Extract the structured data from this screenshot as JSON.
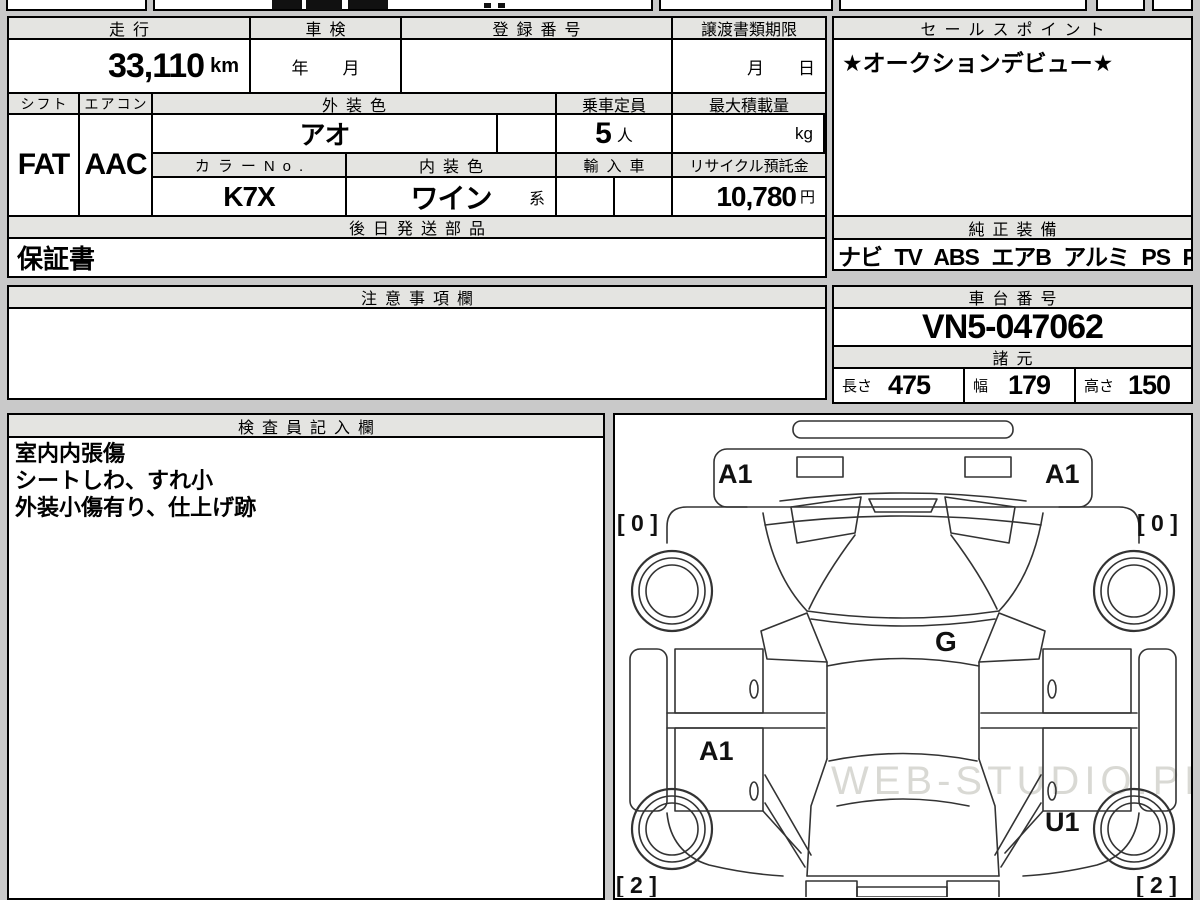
{
  "main_table": {
    "mileage": {
      "header": "走行",
      "value": "33,110",
      "unit": "km"
    },
    "shaken": {
      "header": "車検",
      "placeholder": "年　　月"
    },
    "registration": {
      "header": "登録番号",
      "value": ""
    },
    "transfer_deadline": {
      "header": "譲渡書類期限",
      "placeholder": "月　　日"
    },
    "shift": {
      "header": "シフト",
      "value": "FAT"
    },
    "aircon": {
      "header": "エアコン",
      "value": "AAC"
    },
    "exterior_color": {
      "header": "外装色",
      "value": "アオ"
    },
    "capacity": {
      "header": "乗車定員",
      "value": "5",
      "unit": "人"
    },
    "max_load": {
      "header": "最大積載量",
      "unit": "kg"
    },
    "color_no": {
      "header": "カラーNo.",
      "value": "K7X"
    },
    "interior_color": {
      "header": "内装色",
      "value": "ワイン",
      "suffix": "系"
    },
    "import_car": {
      "header": "輸入車",
      "value": ""
    },
    "recycle_deposit": {
      "header": "リサイクル預託金",
      "value": "10,780",
      "unit": "円"
    },
    "later_parts": {
      "header": "後日発送部品",
      "value": "保証書"
    }
  },
  "sales_point": {
    "header": "セールスポイント",
    "text": "★オークションデビュー★"
  },
  "genuine_equipment": {
    "header": "純正装備",
    "items": "ナビ TV ABS エアB アルミ PS PW"
  },
  "notes": {
    "header": "注意事項欄",
    "text": ""
  },
  "chassis": {
    "header": "車台番号",
    "value": "VN5-047062"
  },
  "specs": {
    "header": "諸元",
    "length_label": "長さ",
    "length": "475",
    "width_label": "幅",
    "width": "179",
    "height_label": "高さ",
    "height": "150"
  },
  "inspector": {
    "header": "検査員記入欄",
    "lines": [
      "室内内張傷",
      "シートしわ、すれ小",
      "外装小傷有り、仕上げ跡"
    ]
  },
  "diagram": {
    "labels": {
      "bumper_front_left": "A1",
      "bumper_front_right": "A1",
      "tire_front_left": "[ 0 ]",
      "tire_front_right": "[ 0 ]",
      "roof": "G",
      "door_left": "A1",
      "rear_right": "U1",
      "tire_rear_left": "[ 2 ]",
      "tire_rear_right": "[ 2 ]"
    },
    "watermark": "WEB-STUDIO.PRO"
  }
}
